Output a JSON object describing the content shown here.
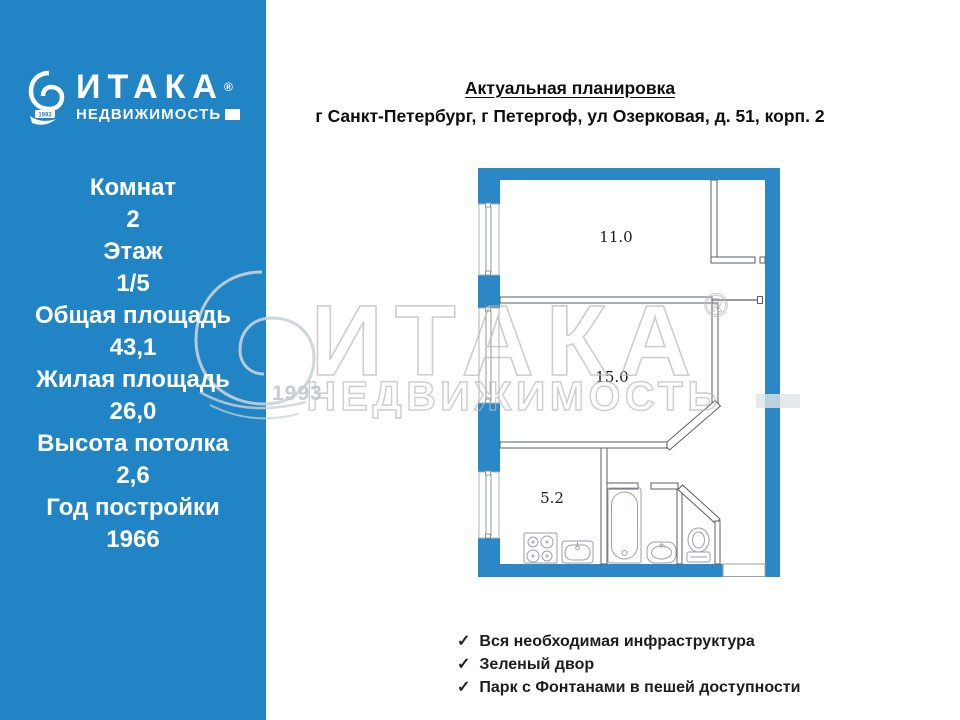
{
  "logo": {
    "brand": "ИТАКА",
    "reg": "®",
    "sub": "НЕДВИЖИМОСТЬ",
    "year": "1993"
  },
  "sidebar": {
    "details": [
      {
        "label": "Комнат",
        "value": "2"
      },
      {
        "label": "Этаж",
        "value": "1/5"
      },
      {
        "label": "Общая площадь",
        "value": "43,1"
      },
      {
        "label": "Жилая площадь",
        "value": "26,0"
      },
      {
        "label": "Высота потолка",
        "value": "2,6"
      },
      {
        "label": "Год постройки",
        "value": "1966"
      }
    ]
  },
  "header": {
    "title": "Актуальная планировка",
    "address": "г Санкт-Петербург, г Петергоф, ул Озерковая, д. 51, корп. 2"
  },
  "floorplan": {
    "rooms": [
      {
        "name": "room-top",
        "area_label": "11.0"
      },
      {
        "name": "room-middle",
        "area_label": "15.0"
      },
      {
        "name": "kitchen",
        "area_label": "5.2"
      }
    ]
  },
  "watermark": {
    "brand": "ИТАКА",
    "reg": "®",
    "sub": "НЕДВИЖИМОСТЬ",
    "year": "1993"
  },
  "features": {
    "check_icon": "✓",
    "items": [
      "Вся необходимая инфраструктура",
      "Зеленый двор",
      "Парк с Фонтанами в пешей доступности"
    ]
  },
  "colors": {
    "accent_blue": "#2185c5",
    "watermark_grey": "#b9b9b9"
  }
}
